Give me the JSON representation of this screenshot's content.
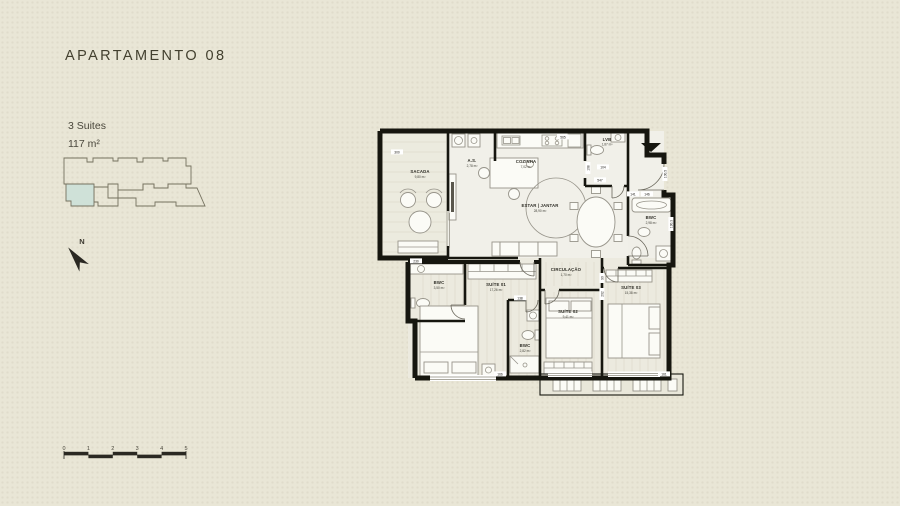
{
  "header": {
    "title": "APARTAMENTO 08",
    "spec_suites": "3 Suites",
    "spec_area": "117 m²"
  },
  "colors": {
    "background": "#e9e6d6",
    "highlight_unit": "#cfe1d8",
    "wall": "#16160f"
  },
  "north": {
    "label": "N"
  },
  "scale_bar": {
    "ticks": [
      "0",
      "1",
      "2",
      "3",
      "4",
      "5"
    ]
  },
  "plan": {
    "rooms": [
      {
        "id": "sacada",
        "name": "SACADA",
        "area": "9,80 m²"
      },
      {
        "id": "as",
        "name": "A.S.",
        "area": "2,78 m²"
      },
      {
        "id": "cozinha",
        "name": "COZINHA",
        "area": "7,02 m²"
      },
      {
        "id": "lvb",
        "name": "LVB",
        "area": "1,87 m²"
      },
      {
        "id": "estar-jantar",
        "name": "ESTAR | JANTAR",
        "area": "28,90 m²"
      },
      {
        "id": "bwc-suite-03",
        "name": "BWC",
        "area": "2,98 m²"
      },
      {
        "id": "circulacao",
        "name": "CIRCULAÇÃO",
        "area": "1,70 m²"
      },
      {
        "id": "bwc-suite-01",
        "name": "BWC",
        "area": "3,50 m²"
      },
      {
        "id": "suite-01",
        "name": "SUÍTE 01",
        "area": "17,26 m²"
      },
      {
        "id": "suite-02",
        "name": "SUÍTE 02",
        "area": "9,41 m²"
      },
      {
        "id": "bwc-suite-02",
        "name": "BWC",
        "area": "2,82 m²"
      },
      {
        "id": "suite-03",
        "name": "SUÍTE 03",
        "area": "15,38 m²"
      }
    ],
    "dimensions": {
      "d300": "300",
      "d565": "565",
      "d108": "108",
      "d104": "104",
      "d547": "547",
      "d141": "141",
      "d146": "146",
      "d100_5": "100.5",
      "d190_3": "190.3",
      "d230": "230",
      "d90": "90",
      "d202": "202",
      "d138": "138",
      "d166": "166",
      "d161": "161"
    }
  }
}
